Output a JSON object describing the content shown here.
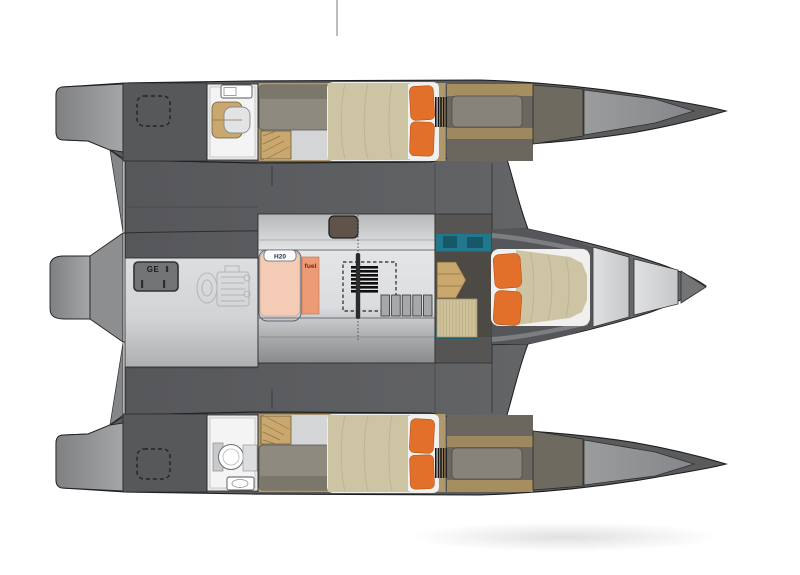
{
  "plan": {
    "labels": {
      "generator": "GE",
      "water_tank": "H20",
      "fuel_tank": "fuel"
    },
    "colors": {
      "pillow_orange": "#e2702b",
      "bed_khaki": "#cdc4a4",
      "teal": "#22778c",
      "water_tank": "#f4cbb5",
      "fuel_tank": "#ec9b77",
      "wood": "#c9a76d",
      "mat": "#cfc198",
      "hull_dark": "#5a5b5d",
      "deck_dark": "#57585a",
      "floor_light": "#d8d9db",
      "cabin_tan": "#b0986e",
      "fuel_text": "#7e2715"
    },
    "features": [
      "port-hull",
      "main-hull",
      "starboard-hull",
      "double-berth",
      "single-berth",
      "toilet",
      "sink",
      "companionway-stairs",
      "water-tank",
      "fuel-tank",
      "generator",
      "engine",
      "mast",
      "deck-hatch",
      "settee",
      "wardrobe-ladder"
    ]
  }
}
